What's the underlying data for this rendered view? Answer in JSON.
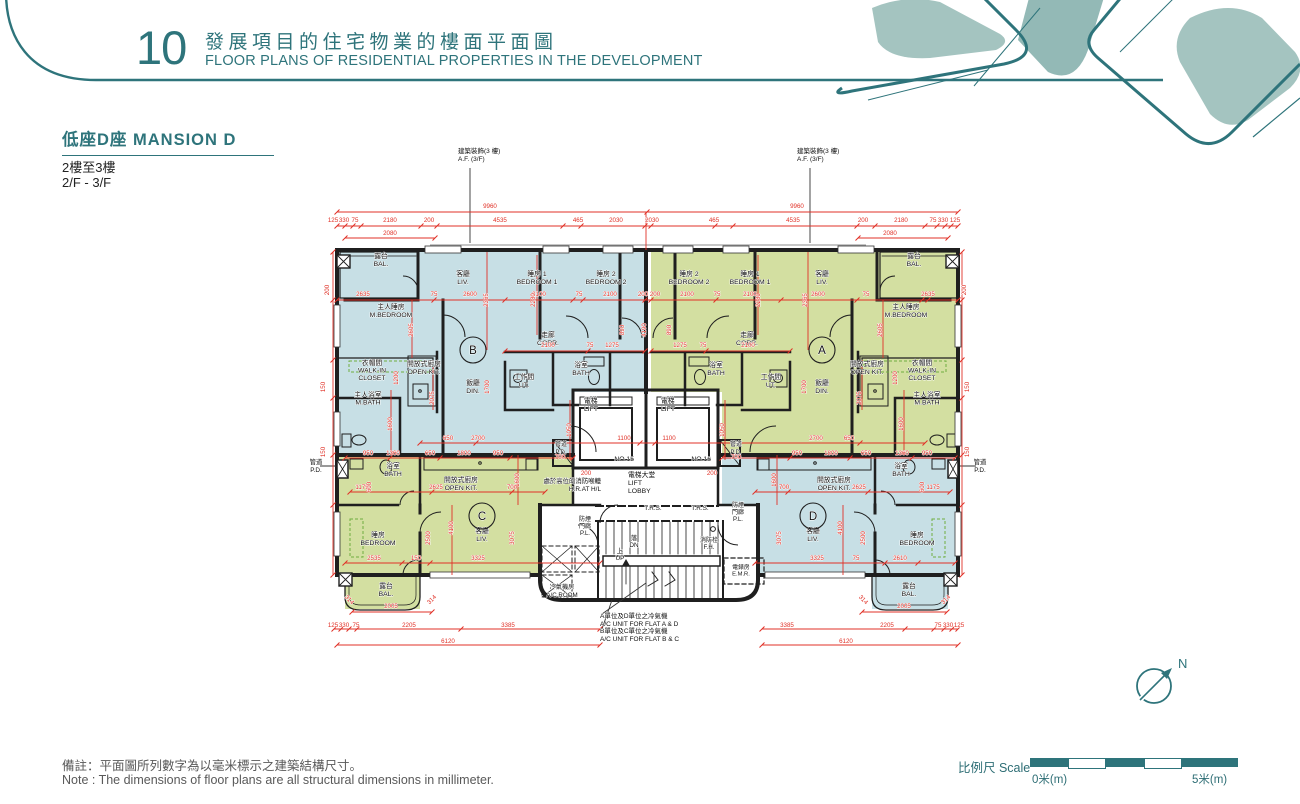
{
  "header": {
    "number": "10",
    "title_zh": "發展項目的住宅物業的樓面平面圖",
    "title_en": "FLOOR PLANS OF RESIDENTIAL PROPERTIES IN THE DEVELOPMENT"
  },
  "section": {
    "title": "低座D座 MANSION D",
    "floor_zh": "2樓至3樓",
    "floor_en": "2/F - 3/F"
  },
  "footer": {
    "note_zh": "備註：平面圖所列數字為以毫米標示之建築結構尺寸。",
    "note_en": "Note : The dimensions of floor plans are all structural dimensions in millimeter.",
    "scale_label": "比例尺 Scale",
    "scale_zero": "0米(m)",
    "scale_five": "5米(m)",
    "north_label": "N"
  },
  "colors": {
    "teal": "#2e747b",
    "flat_blue": "#c7dfe5",
    "flat_green": "#d3dfa1",
    "dim_red": "#e03127",
    "wall": "#1f1f1f"
  },
  "plan": {
    "flat_circles": [
      {
        "l": "B",
        "x": 473,
        "y": 350
      },
      {
        "l": "A",
        "x": 822,
        "y": 350
      },
      {
        "l": "C",
        "x": 482,
        "y": 516
      },
      {
        "l": "D",
        "x": 813,
        "y": 516
      }
    ],
    "room_labels": [
      {
        "t": [
          "露台",
          "BAL."
        ],
        "x": 381,
        "y": 258
      },
      {
        "t": [
          "客廳",
          "LIV."
        ],
        "x": 463,
        "y": 276
      },
      {
        "t": [
          "睡房 1",
          "BEDROOM 1"
        ],
        "x": 537,
        "y": 276
      },
      {
        "t": [
          "睡房 2",
          "BEDROOM 2"
        ],
        "x": 606,
        "y": 276
      },
      {
        "t": [
          "主人睡房",
          "M.BEDROOM"
        ],
        "x": 391,
        "y": 309
      },
      {
        "t": [
          "走廊",
          "CORR."
        ],
        "x": 548,
        "y": 337
      },
      {
        "t": [
          "衣帽間",
          "WALK-IN",
          "CLOSET"
        ],
        "x": 372,
        "y": 365,
        "lh": 7.5
      },
      {
        "t": [
          "開放式廚房",
          "OPEN KIT."
        ],
        "x": 424,
        "y": 366
      },
      {
        "t": [
          "飯廳",
          "DIN."
        ],
        "x": 473,
        "y": 385
      },
      {
        "t": [
          "工作間",
          "UT."
        ],
        "x": 524,
        "y": 379
      },
      {
        "t": [
          "浴室",
          "BATH"
        ],
        "x": 581,
        "y": 367
      },
      {
        "t": [
          "主人浴室",
          "M.BATH"
        ],
        "x": 368,
        "y": 397,
        "lh": 7.5
      },
      {
        "t": [
          "露台",
          "BAL."
        ],
        "x": 914,
        "y": 258
      },
      {
        "t": [
          "客廳",
          "LIV."
        ],
        "x": 822,
        "y": 276
      },
      {
        "t": [
          "睡房 1",
          "BEDROOM 1"
        ],
        "x": 750,
        "y": 276
      },
      {
        "t": [
          "睡房 2",
          "BEDROOM 2"
        ],
        "x": 689,
        "y": 276
      },
      {
        "t": [
          "主人睡房",
          "M.BEDROOM"
        ],
        "x": 906,
        "y": 309
      },
      {
        "t": [
          "走廊",
          "CORR."
        ],
        "x": 747,
        "y": 337
      },
      {
        "t": [
          "衣帽間",
          "WALK-IN",
          "CLOSET"
        ],
        "x": 922,
        "y": 365,
        "lh": 7.5
      },
      {
        "t": [
          "開放式廚房",
          "OPEN KIT."
        ],
        "x": 867,
        "y": 366
      },
      {
        "t": [
          "飯廳",
          "DIN."
        ],
        "x": 822,
        "y": 385
      },
      {
        "t": [
          "工作間",
          "UT."
        ],
        "x": 771,
        "y": 379
      },
      {
        "t": [
          "浴室",
          "BATH"
        ],
        "x": 716,
        "y": 367
      },
      {
        "t": [
          "主人浴室",
          "M.BATH"
        ],
        "x": 927,
        "y": 397,
        "lh": 7.5
      },
      {
        "t": [
          "浴室",
          "BATH"
        ],
        "x": 393,
        "y": 468
      },
      {
        "t": [
          "開放式廚房",
          "OPEN KIT."
        ],
        "x": 461,
        "y": 482
      },
      {
        "t": [
          "客廳",
          "LIV."
        ],
        "x": 482,
        "y": 533
      },
      {
        "t": [
          "睡房",
          "BEDROOM"
        ],
        "x": 378,
        "y": 537
      },
      {
        "t": [
          "露台",
          "BAL."
        ],
        "x": 386,
        "y": 588
      },
      {
        "t": [
          "浴室",
          "BATH"
        ],
        "x": 901,
        "y": 468
      },
      {
        "t": [
          "開放式廚房",
          "OPEN KIT."
        ],
        "x": 834,
        "y": 482
      },
      {
        "t": [
          "客廳",
          "LIV."
        ],
        "x": 813,
        "y": 533
      },
      {
        "t": [
          "睡房",
          "BEDROOM"
        ],
        "x": 917,
        "y": 537
      },
      {
        "t": [
          "露台",
          "BAL."
        ],
        "x": 909,
        "y": 588
      },
      {
        "t": [
          "電梯",
          "LIFT"
        ],
        "x": 584,
        "y": 403,
        "a": "s"
      },
      {
        "t": [
          "電梯",
          "LIFT"
        ],
        "x": 661,
        "y": 403,
        "a": "s"
      },
      {
        "t": [
          "NO.15"
        ],
        "x": 634,
        "y": 461,
        "a": "e"
      },
      {
        "t": [
          "NO.16"
        ],
        "x": 711,
        "y": 461,
        "a": "e"
      },
      {
        "t": [
          "管道",
          "P.D."
        ],
        "x": 561,
        "y": 446,
        "s": 6
      },
      {
        "t": [
          "管道",
          "P.D."
        ],
        "x": 736,
        "y": 446,
        "s": 6
      },
      {
        "t": [
          "管道",
          "P.D."
        ],
        "x": 316,
        "y": 464,
        "s": 6.4
      },
      {
        "t": [
          "管道",
          "P.D."
        ],
        "x": 980,
        "y": 464,
        "s": 6.4
      },
      {
        "t": [
          "電梯大堂",
          "LIFT",
          "LOBBY"
        ],
        "x": 628,
        "y": 477,
        "a": "s"
      },
      {
        "t": [
          "處於高位的消防喉轆",
          "H.R.AT H/L"
        ],
        "x": 601,
        "y": 483,
        "a": "e",
        "s": 6.4
      },
      {
        "t": [
          "T.R.S."
        ],
        "x": 653,
        "y": 510,
        "s": 6.4
      },
      {
        "t": [
          "T.R.S."
        ],
        "x": 700,
        "y": 510,
        "s": 6.4
      },
      {
        "t": [
          "防煙",
          "門廊",
          "P.L."
        ],
        "x": 738,
        "y": 507,
        "lh": 7,
        "s": 6
      },
      {
        "t": [
          "防煙",
          "門廊",
          "P.L."
        ],
        "x": 585,
        "y": 521,
        "lh": 7,
        "s": 6
      },
      {
        "t": [
          "落",
          "DN"
        ],
        "x": 634,
        "y": 540,
        "lh": 7,
        "s": 6.4
      },
      {
        "t": [
          "上",
          "UP"
        ],
        "x": 620,
        "y": 553,
        "lh": 7,
        "s": 6.4
      },
      {
        "t": [
          "消防栓",
          "F.H."
        ],
        "x": 709,
        "y": 542,
        "lh": 7,
        "s": 6
      },
      {
        "t": [
          "電錶房",
          "E.M.R."
        ],
        "x": 741,
        "y": 569,
        "lh": 6.5,
        "s": 5.8
      },
      {
        "t": [
          "冷氣機房",
          "A/C ROOM"
        ],
        "x": 562,
        "y": 589,
        "s": 6.2
      },
      {
        "t": [
          "建築裝飾(3 樓)",
          "A.F. (3/F)"
        ],
        "x": 458,
        "y": 153,
        "a": "s",
        "s": 6.5
      },
      {
        "t": [
          "建築裝飾(3 樓)",
          "A.F. (3/F)"
        ],
        "x": 797,
        "y": 153,
        "a": "s",
        "s": 6.5
      },
      {
        "t": [
          "A單位及D單位之冷氣機",
          "A/C UNIT FOR FLAT A & D"
        ],
        "x": 600,
        "y": 618,
        "a": "s",
        "s": 6.5
      },
      {
        "t": [
          "B單位及C單位之冷氣機",
          "A/C UNIT FOR FLAT B & C"
        ],
        "x": 600,
        "y": 633,
        "a": "s",
        "s": 6.5
      }
    ],
    "dim_labels": [
      {
        "t": "9960",
        "x": 490,
        "y": 208
      },
      {
        "t": "9960",
        "x": 797,
        "y": 208
      },
      {
        "t": "125",
        "x": 333,
        "y": 222
      },
      {
        "t": "330",
        "x": 344,
        "y": 222
      },
      {
        "t": "75",
        "x": 355,
        "y": 222
      },
      {
        "t": "2180",
        "x": 390,
        "y": 222
      },
      {
        "t": "200",
        "x": 429,
        "y": 222
      },
      {
        "t": "4535",
        "x": 500,
        "y": 222
      },
      {
        "t": "465",
        "x": 578,
        "y": 222
      },
      {
        "t": "2030",
        "x": 616,
        "y": 222
      },
      {
        "t": "2030",
        "x": 652,
        "y": 222
      },
      {
        "t": "465",
        "x": 714,
        "y": 222
      },
      {
        "t": "4535",
        "x": 793,
        "y": 222
      },
      {
        "t": "200",
        "x": 863,
        "y": 222
      },
      {
        "t": "2180",
        "x": 901,
        "y": 222
      },
      {
        "t": "75",
        "x": 933,
        "y": 222
      },
      {
        "t": "330",
        "x": 943,
        "y": 222
      },
      {
        "t": "125",
        "x": 955,
        "y": 222
      },
      {
        "t": "2080",
        "x": 390,
        "y": 235
      },
      {
        "t": "2080",
        "x": 890,
        "y": 235
      },
      {
        "t": "2635",
        "x": 363,
        "y": 296
      },
      {
        "t": "75",
        "x": 434,
        "y": 296
      },
      {
        "t": "2600",
        "x": 470,
        "y": 296
      },
      {
        "t": "2100",
        "x": 539,
        "y": 296
      },
      {
        "t": "75",
        "x": 579,
        "y": 296
      },
      {
        "t": "2100",
        "x": 610,
        "y": 296
      },
      {
        "t": "200",
        "x": 643,
        "y": 296
      },
      {
        "t": "200",
        "x": 655,
        "y": 296
      },
      {
        "t": "2100",
        "x": 687,
        "y": 296
      },
      {
        "t": "75",
        "x": 717,
        "y": 296
      },
      {
        "t": "2100",
        "x": 750,
        "y": 296
      },
      {
        "t": "2600",
        "x": 818,
        "y": 296
      },
      {
        "t": "75",
        "x": 866,
        "y": 296
      },
      {
        "t": "2635",
        "x": 928,
        "y": 296
      },
      {
        "t": "2100",
        "x": 548,
        "y": 347
      },
      {
        "t": "75",
        "x": 590,
        "y": 347
      },
      {
        "t": "1275",
        "x": 612,
        "y": 347
      },
      {
        "t": "1275",
        "x": 680,
        "y": 347
      },
      {
        "t": "75",
        "x": 703,
        "y": 347
      },
      {
        "t": "2100",
        "x": 748,
        "y": 347
      },
      {
        "t": "650",
        "x": 448,
        "y": 440
      },
      {
        "t": "2700",
        "x": 478,
        "y": 440
      },
      {
        "t": "1100",
        "x": 624,
        "y": 440
      },
      {
        "t": "1100",
        "x": 669,
        "y": 440
      },
      {
        "t": "2700",
        "x": 816,
        "y": 440
      },
      {
        "t": "650",
        "x": 849,
        "y": 440
      },
      {
        "t": "700",
        "x": 560,
        "y": 459
      },
      {
        "t": "700",
        "x": 736,
        "y": 459
      },
      {
        "t": "200",
        "x": 586,
        "y": 475
      },
      {
        "t": "200",
        "x": 712,
        "y": 475
      },
      {
        "t": "950",
        "x": 368,
        "y": 455
      },
      {
        "t": "1360",
        "x": 393,
        "y": 455
      },
      {
        "t": "650",
        "x": 430,
        "y": 455
      },
      {
        "t": "1800",
        "x": 464,
        "y": 455
      },
      {
        "t": "950",
        "x": 498,
        "y": 455
      },
      {
        "t": "950",
        "x": 797,
        "y": 455
      },
      {
        "t": "1800",
        "x": 831,
        "y": 455
      },
      {
        "t": "650",
        "x": 866,
        "y": 455
      },
      {
        "t": "1360",
        "x": 902,
        "y": 455
      },
      {
        "t": "950",
        "x": 927,
        "y": 455
      },
      {
        "t": "1175",
        "x": 362,
        "y": 489
      },
      {
        "t": "2625",
        "x": 436,
        "y": 489
      },
      {
        "t": "700",
        "x": 512,
        "y": 489
      },
      {
        "t": "700",
        "x": 784,
        "y": 489
      },
      {
        "t": "2625",
        "x": 859,
        "y": 489
      },
      {
        "t": "1175",
        "x": 933,
        "y": 489
      },
      {
        "t": "2535",
        "x": 374,
        "y": 560
      },
      {
        "t": "150",
        "x": 416,
        "y": 560
      },
      {
        "t": "3325",
        "x": 478,
        "y": 560
      },
      {
        "t": "3325",
        "x": 817,
        "y": 560
      },
      {
        "t": "75",
        "x": 856,
        "y": 560
      },
      {
        "t": "2610",
        "x": 900,
        "y": 560
      },
      {
        "t": "2005",
        "x": 391,
        "y": 608
      },
      {
        "t": "2005",
        "x": 904,
        "y": 608
      },
      {
        "t": "125",
        "x": 333,
        "y": 627
      },
      {
        "t": "330",
        "x": 344,
        "y": 627
      },
      {
        "t": "75",
        "x": 356,
        "y": 627
      },
      {
        "t": "2205",
        "x": 409,
        "y": 627
      },
      {
        "t": "3385",
        "x": 508,
        "y": 627
      },
      {
        "t": "3385",
        "x": 787,
        "y": 627
      },
      {
        "t": "2205",
        "x": 887,
        "y": 627
      },
      {
        "t": "75",
        "x": 938,
        "y": 627
      },
      {
        "t": "330",
        "x": 948,
        "y": 627
      },
      {
        "t": "125",
        "x": 959,
        "y": 627
      },
      {
        "t": "6120",
        "x": 448,
        "y": 643
      },
      {
        "t": "6120",
        "x": 846,
        "y": 643
      },
      {
        "t": "2365",
        "x": 488,
        "y": 300,
        "r": -90
      },
      {
        "t": "2280",
        "x": 535,
        "y": 300,
        "r": -90
      },
      {
        "t": "2280",
        "x": 760,
        "y": 300,
        "r": -90
      },
      {
        "t": "2365",
        "x": 807,
        "y": 300,
        "r": -90
      },
      {
        "t": "2605",
        "x": 413,
        "y": 330,
        "r": -90
      },
      {
        "t": "2605",
        "x": 882,
        "y": 330,
        "r": -90
      },
      {
        "t": "4190",
        "x": 646,
        "y": 330,
        "r": -90
      },
      {
        "t": "890",
        "x": 624,
        "y": 330,
        "r": -90
      },
      {
        "t": "890",
        "x": 671,
        "y": 330,
        "r": -90
      },
      {
        "t": "1700",
        "x": 489,
        "y": 387,
        "r": -90
      },
      {
        "t": "1700",
        "x": 806,
        "y": 387,
        "r": -90
      },
      {
        "t": "2075",
        "x": 434,
        "y": 398,
        "r": -90
      },
      {
        "t": "2075",
        "x": 861,
        "y": 398,
        "r": -90
      },
      {
        "t": "1200",
        "x": 398,
        "y": 378,
        "r": -90
      },
      {
        "t": "1200",
        "x": 897,
        "y": 378,
        "r": -90
      },
      {
        "t": "1600",
        "x": 392,
        "y": 424,
        "r": -90
      },
      {
        "t": "1600",
        "x": 903,
        "y": 424,
        "r": -90
      },
      {
        "t": "1050",
        "x": 571,
        "y": 430,
        "r": -90
      },
      {
        "t": "1050",
        "x": 724,
        "y": 430,
        "r": -90
      },
      {
        "t": "1600",
        "x": 519,
        "y": 480,
        "r": -90
      },
      {
        "t": "1600",
        "x": 776,
        "y": 480,
        "r": -90
      },
      {
        "t": "600",
        "x": 371,
        "y": 487,
        "r": -90
      },
      {
        "t": "600",
        "x": 924,
        "y": 487,
        "r": -90
      },
      {
        "t": "4100",
        "x": 453,
        "y": 528,
        "r": -90
      },
      {
        "t": "4100",
        "x": 842,
        "y": 528,
        "r": -90
      },
      {
        "t": "2500",
        "x": 430,
        "y": 538,
        "r": -90
      },
      {
        "t": "2500",
        "x": 865,
        "y": 538,
        "r": -90
      },
      {
        "t": "3075",
        "x": 514,
        "y": 538,
        "r": -90
      },
      {
        "t": "3075",
        "x": 781,
        "y": 538,
        "r": -90
      },
      {
        "t": "200",
        "x": 329,
        "y": 290,
        "r": -90
      },
      {
        "t": "150",
        "x": 325,
        "y": 387,
        "r": -90
      },
      {
        "t": "150",
        "x": 325,
        "y": 452,
        "r": -90
      },
      {
        "t": "200",
        "x": 966,
        "y": 290,
        "r": -90
      },
      {
        "t": "150",
        "x": 969,
        "y": 387,
        "r": -90
      },
      {
        "t": "150",
        "x": 969,
        "y": 452,
        "r": -90
      },
      {
        "t": "314",
        "x": 348,
        "y": 601,
        "r": 45
      },
      {
        "t": "314",
        "x": 433,
        "y": 601,
        "r": -45
      },
      {
        "t": "314",
        "x": 862,
        "y": 601,
        "r": 45
      },
      {
        "t": "314",
        "x": 947,
        "y": 601,
        "r": -45
      }
    ]
  }
}
